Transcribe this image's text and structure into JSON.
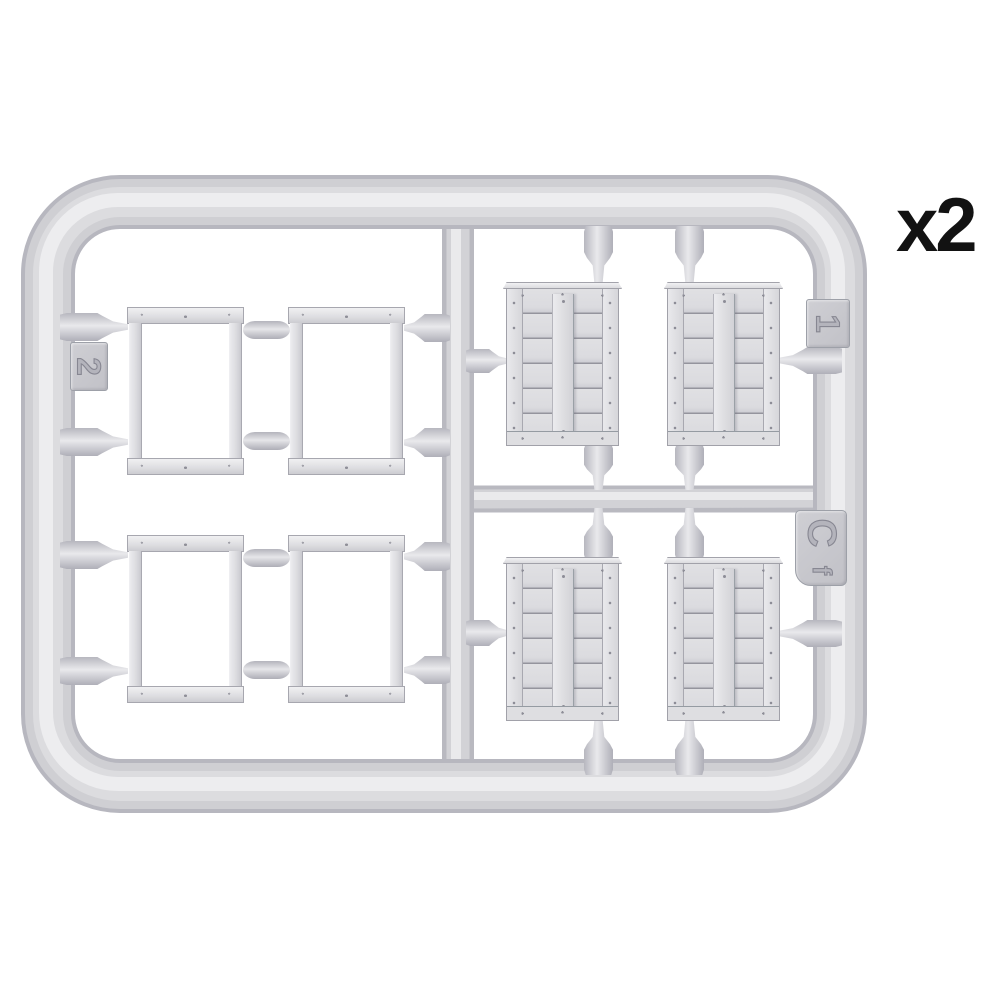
{
  "scene": {
    "description": "Grey injection-moulded model kit sprue with four open rectangular frame parts (left half) and four planked panel parts (right half)",
    "quantity_label": "x2",
    "molded_tags": {
      "left_gate_number": "2",
      "right_gate_number": "1",
      "sprue_code_letter": "C",
      "sprue_code_suffix": "f"
    },
    "colors": {
      "background": "#ffffff",
      "plastic_base": "#cfcfd3",
      "plastic_edge": "#b9b9c0",
      "plastic_highlight": "#ebebee",
      "part_fill": "#dbdbde",
      "panel_line": "#94949d",
      "label_text": "#121212"
    }
  }
}
